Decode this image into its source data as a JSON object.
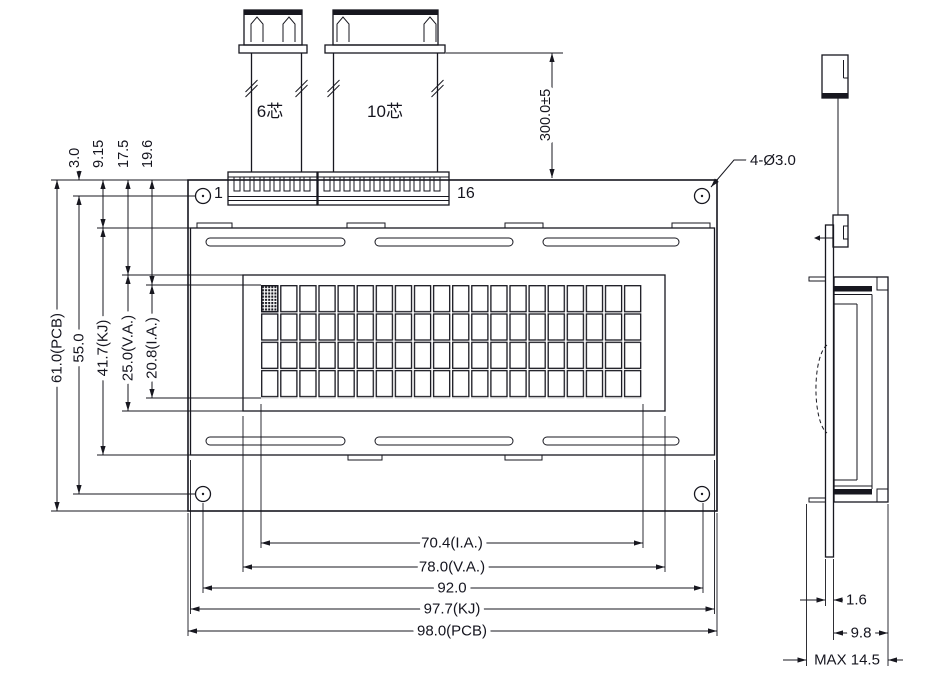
{
  "drawing": {
    "background": "#ffffff",
    "line_color": "#17171f",
    "front_view": {
      "pin_first": "1",
      "pin_last": "16",
      "cable_6_label": "6芯",
      "cable_10_label": "10芯",
      "mounting_hole_callout": "4-Ø3.0",
      "cable_length_dim": "300.0±5"
    },
    "dims_vertical_left": {
      "hole_offset": "3.0",
      "bezel_offset": "9.15",
      "va_offset": "17.5",
      "ia_offset": "19.6",
      "pcb_height": "61.0(PCB)",
      "hole_span": "55.0",
      "bezel_height": "41.7(KJ)",
      "va_height": "25.0(V.A.)",
      "ia_height": "20.8(I.A.)"
    },
    "dims_horizontal_bottom": {
      "ia_width": "70.4(I.A.)",
      "va_width": "78.0(V.A.)",
      "hole_span": "92.0",
      "bezel_width": "97.7(KJ)",
      "pcb_width": "98.0(PCB)"
    },
    "side_view": {
      "pcb_thickness": "1.6",
      "module_depth": "9.8",
      "max_depth": "MAX 14.5"
    }
  }
}
